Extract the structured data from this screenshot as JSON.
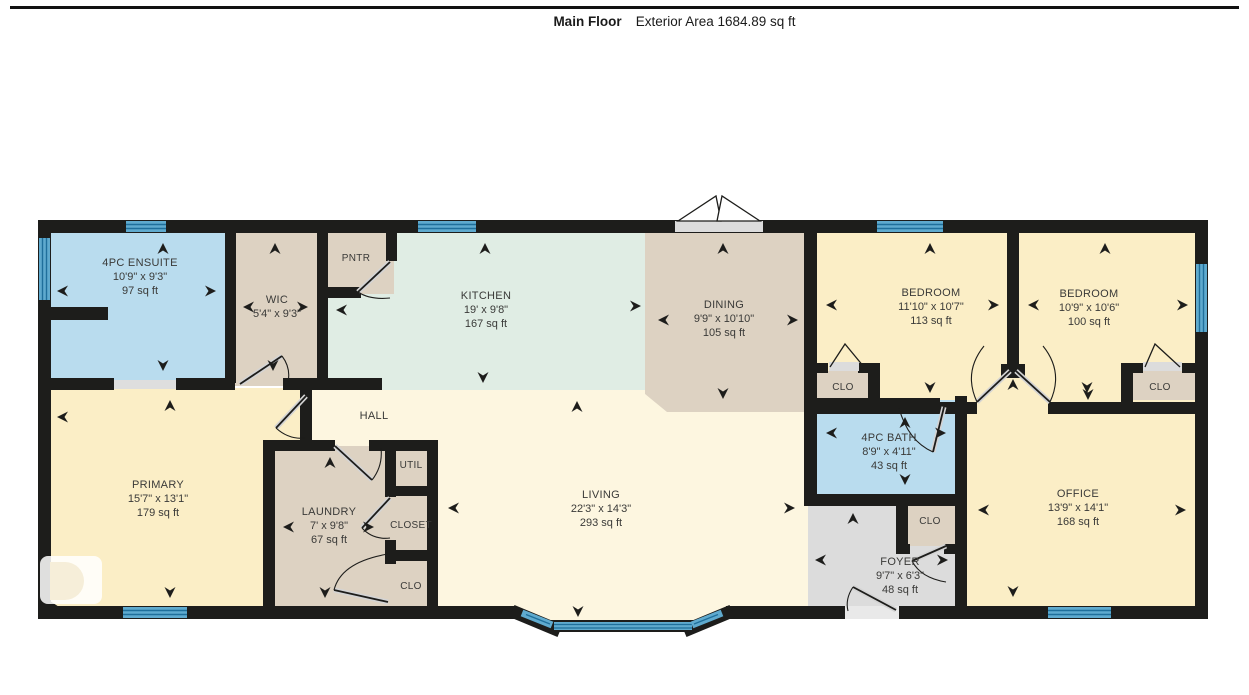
{
  "title": {
    "floor_name": "Main Floor",
    "area_label": "Exterior Area 1684.89 sq ft"
  },
  "rooms": [
    {
      "id": "ensuite",
      "name": "4PC ENSUITE",
      "dims": "10'9\" x 9'3\"",
      "area": "97 sq ft"
    },
    {
      "id": "wic",
      "name": "WIC",
      "dims": "5'4\" x 9'3\"",
      "area": ""
    },
    {
      "id": "pantry",
      "name": "PNTR",
      "dims": "",
      "area": ""
    },
    {
      "id": "kitchen",
      "name": "KITCHEN",
      "dims": "19' x 9'8\"",
      "area": "167 sq ft"
    },
    {
      "id": "dining",
      "name": "DINING",
      "dims": "9'9\" x 10'10\"",
      "area": "105 sq ft"
    },
    {
      "id": "bedroom1",
      "name": "BEDROOM",
      "dims": "11'10\" x 10'7\"",
      "area": "113 sq ft"
    },
    {
      "id": "bedroom2",
      "name": "BEDROOM",
      "dims": "10'9\" x 10'6\"",
      "area": "100 sq ft"
    },
    {
      "id": "closet-bedroom1",
      "name": "CLO",
      "dims": "",
      "area": ""
    },
    {
      "id": "closet-bedroom2",
      "name": "CLO",
      "dims": "",
      "area": ""
    },
    {
      "id": "bath",
      "name": "4PC BATH",
      "dims": "8'9\" x 4'11\"",
      "area": "43 sq ft"
    },
    {
      "id": "closet-foyer",
      "name": "CLO",
      "dims": "",
      "area": ""
    },
    {
      "id": "foyer",
      "name": "FOYER",
      "dims": "9'7\" x 6'3\"",
      "area": "48 sq ft"
    },
    {
      "id": "office",
      "name": "OFFICE",
      "dims": "13'9\" x 14'1\"",
      "area": "168 sq ft"
    },
    {
      "id": "living",
      "name": "LIVING",
      "dims": "22'3\" x 14'3\"",
      "area": "293 sq ft"
    },
    {
      "id": "primary",
      "name": "PRIMARY",
      "dims": "15'7\" x 13'1\"",
      "area": "179 sq ft"
    },
    {
      "id": "hall",
      "name": "HALL",
      "dims": "",
      "area": ""
    },
    {
      "id": "laundry",
      "name": "LAUNDRY",
      "dims": "7' x 9'8\"",
      "area": "67 sq ft"
    },
    {
      "id": "util",
      "name": "UTIL",
      "dims": "",
      "area": ""
    },
    {
      "id": "closet-laundry-wall",
      "name": "CLOSET",
      "dims": "",
      "area": ""
    },
    {
      "id": "clo-laundry",
      "name": "CLO",
      "dims": "",
      "area": ""
    }
  ],
  "colors": {
    "wall": "#1d1d1b",
    "wet_room_blue": "#b9dcee",
    "tan": "#ddd2c2",
    "kitchen_green": "#e0ede4",
    "bedroom_yellow": "#fbeec6",
    "living_cream": "#fdf6e0",
    "foyer_gray": "#dcdcdc",
    "window_blue": "#5faace",
    "window_stripe": "#1f6f9b"
  }
}
